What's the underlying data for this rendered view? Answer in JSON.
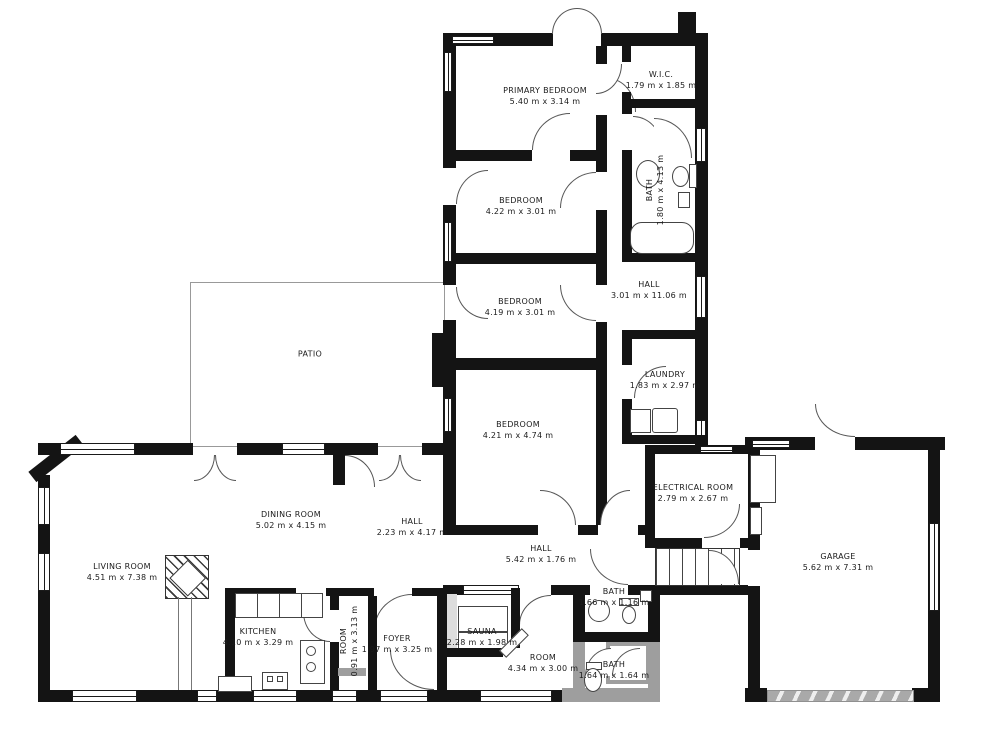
{
  "plan": {
    "colors": {
      "wall": "#141414",
      "gray_wall": "#9e9e9e",
      "line": "#555555"
    },
    "rooms": [
      {
        "name": "PRIMARY BEDROOM",
        "dims": "5.40 m x 3.14 m"
      },
      {
        "name": "W.I.C.",
        "dims": "1.79 m x 1.85 m"
      },
      {
        "name": "BATH",
        "dims": "1.80 m x 4.13 m"
      },
      {
        "name": "BEDROOM",
        "dims": "4.22 m x 3.01 m"
      },
      {
        "name": "HALL",
        "dims": "3.01 m x 11.06 m"
      },
      {
        "name": "BEDROOM",
        "dims": "4.19 m x 3.01 m"
      },
      {
        "name": "LAUNDRY",
        "dims": "1.83 m x 2.97 m"
      },
      {
        "name": "PATIO",
        "dims": ""
      },
      {
        "name": "BEDROOM",
        "dims": "4.21 m x 4.74 m"
      },
      {
        "name": "ELECTRICAL ROOM",
        "dims": "2.79 m x 2.67 m"
      },
      {
        "name": "DINING ROOM",
        "dims": "5.02 m x 4.15 m"
      },
      {
        "name": "HALL",
        "dims": "2.23 m x 4.17 m"
      },
      {
        "name": "HALL",
        "dims": "5.42 m x 1.76 m"
      },
      {
        "name": "GARAGE",
        "dims": "5.62 m x 7.31 m"
      },
      {
        "name": "LIVING ROOM",
        "dims": "4.51 m x 7.38 m"
      },
      {
        "name": "BATH",
        "dims": "1.66 m x 1.16 m"
      },
      {
        "name": "KITCHEN",
        "dims": "4.10 m x 3.29 m"
      },
      {
        "name": "ROOM",
        "dims": "0.91 m x 3.13 m"
      },
      {
        "name": "FOYER",
        "dims": "1.97 m x 3.25 m"
      },
      {
        "name": "SAUNA",
        "dims": "2.28 m x 1.98 m"
      },
      {
        "name": "ROOM",
        "dims": "4.34 m x 3.00 m"
      },
      {
        "name": "BATH",
        "dims": "1.64 m x 1.64 m"
      }
    ]
  }
}
